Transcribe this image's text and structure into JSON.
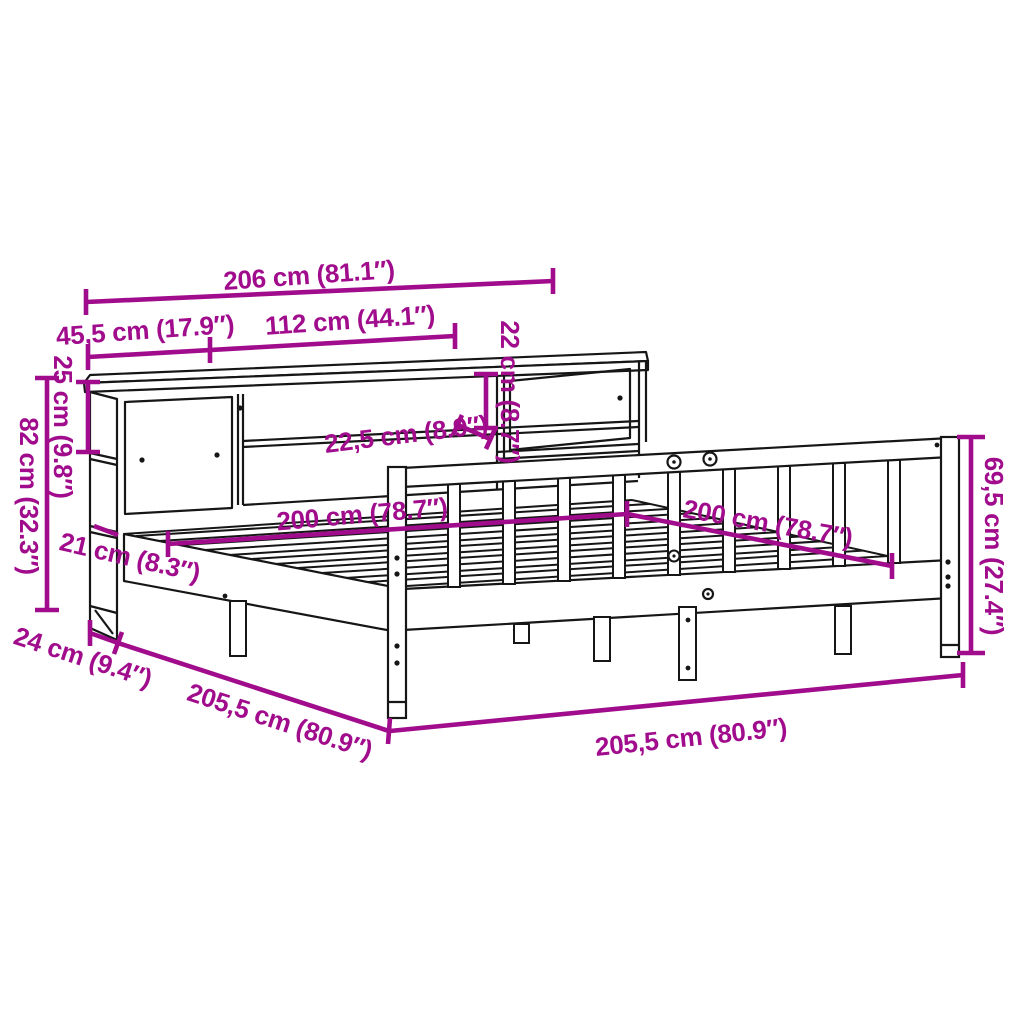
{
  "diagram": {
    "kind": "product-dimension-diagram",
    "subject": "bookcase bed with shelf headboard (isometric line drawing)",
    "background_color": "#ffffff",
    "line_color": "#161616",
    "dimension_color": "#A00C8C"
  },
  "dimensions": [
    {
      "id": "headboard-total-width",
      "cm": "206",
      "inch": "81.1",
      "text": "206 cm (81.1″)"
    },
    {
      "id": "side-unit-width",
      "cm": "45,5",
      "inch": "17.9",
      "text": "45,5 cm (17.9″)"
    },
    {
      "id": "middle-section-width",
      "cm": "112",
      "inch": "44.1",
      "text": "112 cm (44.1″)"
    },
    {
      "id": "shelf-opening-height",
      "cm": "22",
      "inch": "8.7",
      "text": "22 cm (8.7″)"
    },
    {
      "id": "top-compartment-height",
      "cm": "25",
      "inch": "9.8",
      "text": "25 cm (9.8″)"
    },
    {
      "id": "headboard-height",
      "cm": "82",
      "inch": "32.3",
      "text": "82 cm (32.3″)"
    },
    {
      "id": "shelf-depth",
      "cm": "22,5",
      "inch": "8.9",
      "text": "22,5 cm (8.9″)"
    },
    {
      "id": "mattress-width",
      "cm": "200",
      "inch": "78.7",
      "text": "200 cm (78.7″)"
    },
    {
      "id": "mattress-length",
      "cm": "200",
      "inch": "78.7",
      "text": "200 cm (78.7″)"
    },
    {
      "id": "footboard-height",
      "cm": "69,5",
      "inch": "27.4",
      "text": "69,5 cm (27.4″)"
    },
    {
      "id": "side-rail-height",
      "cm": "21",
      "inch": "8.3",
      "text": "21 cm (8.3″)"
    },
    {
      "id": "headboard-depth",
      "cm": "24",
      "inch": "9.4",
      "text": "24 cm (9.4″)"
    },
    {
      "id": "frame-length",
      "cm": "205,5",
      "inch": "80.9",
      "text": "205,5 cm (80.9″)"
    },
    {
      "id": "frame-width",
      "cm": "205,5",
      "inch": "80.9",
      "text": "205,5 cm (80.9″)"
    }
  ]
}
